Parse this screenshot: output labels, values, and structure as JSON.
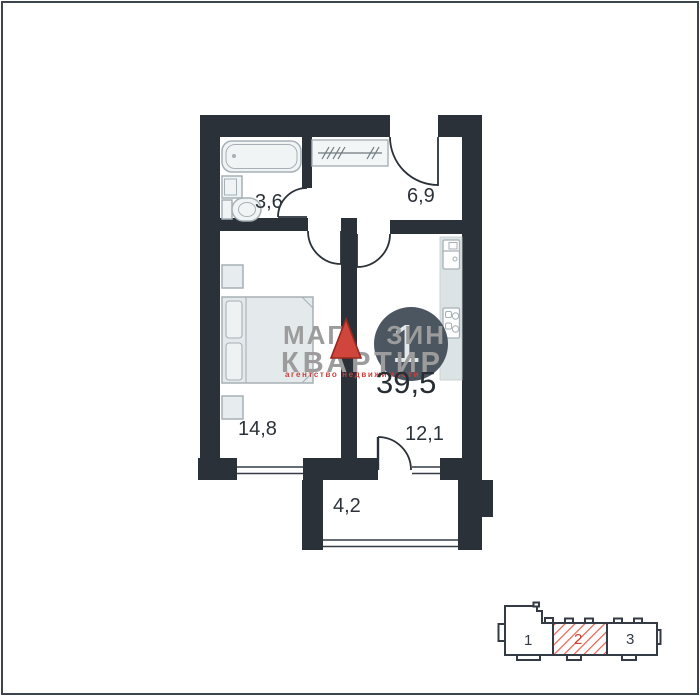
{
  "watermark": {
    "line1_left": "МАГ",
    "line1_right": "ЗИН",
    "line2": "КВАРТИР",
    "tagline": "агентство  недвижимости"
  },
  "apartment": {
    "number": "1",
    "total_area": "39,5",
    "rooms": {
      "bathroom": "3,6",
      "hallway": "6,9",
      "living": "14,8",
      "kitchen": "12,1",
      "balcony": "4,2"
    }
  },
  "locator": {
    "sections": [
      {
        "label": "1",
        "highlighted": false
      },
      {
        "label": "2",
        "highlighted": true
      },
      {
        "label": "3",
        "highlighted": false
      }
    ]
  },
  "icons": [
    "bathtub-icon",
    "bathroom-sink-icon",
    "toilet-icon",
    "wardrobe-icon",
    "bed-icon",
    "nightstand-icon",
    "kitchen-counter",
    "kitchen-sink-icon",
    "stove-icon"
  ],
  "colors": {
    "wall": "#2a3138",
    "furniture_stroke": "#a6b0b6",
    "furniture_fill": "#e7ecee",
    "counter_fill": "#dce3e5",
    "accent_red": "#d0453c",
    "watermark_gray": "#9c9c9c",
    "badge_background": "#434e59"
  }
}
